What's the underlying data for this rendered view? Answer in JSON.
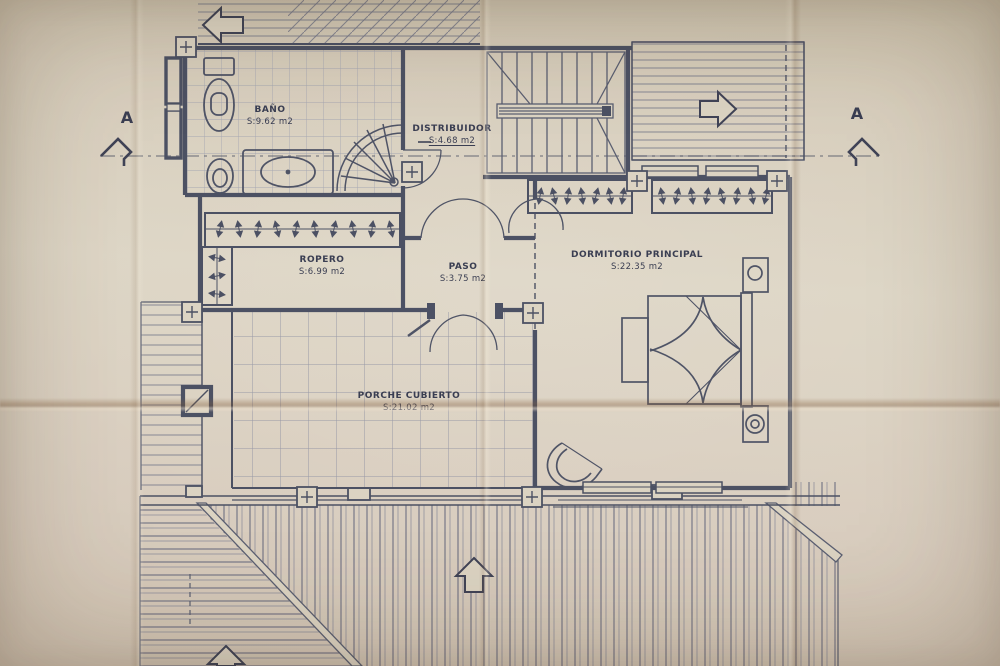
{
  "document": {
    "kind": "architectural floor plan photo",
    "language": "es"
  },
  "section_markers": {
    "left_label": "A",
    "right_label": "A"
  },
  "rooms": [
    {
      "id": "bano",
      "name": "BAÑO",
      "area": "S:9.62  m2"
    },
    {
      "id": "distribuidor",
      "name": "DISTRIBUIDOR",
      "area": "S:4.68  m2"
    },
    {
      "id": "ropero",
      "name": "ROPERO",
      "area": "S:6.99  m2"
    },
    {
      "id": "paso",
      "name": "PASO",
      "area": "S:3.75  m2"
    },
    {
      "id": "dormitorio",
      "name": "DORMITORIO  PRINCIPAL",
      "area": "S:22.35  m2"
    },
    {
      "id": "porche",
      "name": "PORCHE  CUBIERTO",
      "area": "S:21.02  m2"
    }
  ],
  "colors": {
    "paper": "#dcd4c3",
    "ink": "#474c60",
    "hatch": "#6e7286",
    "crease": "#8a5f3c"
  }
}
